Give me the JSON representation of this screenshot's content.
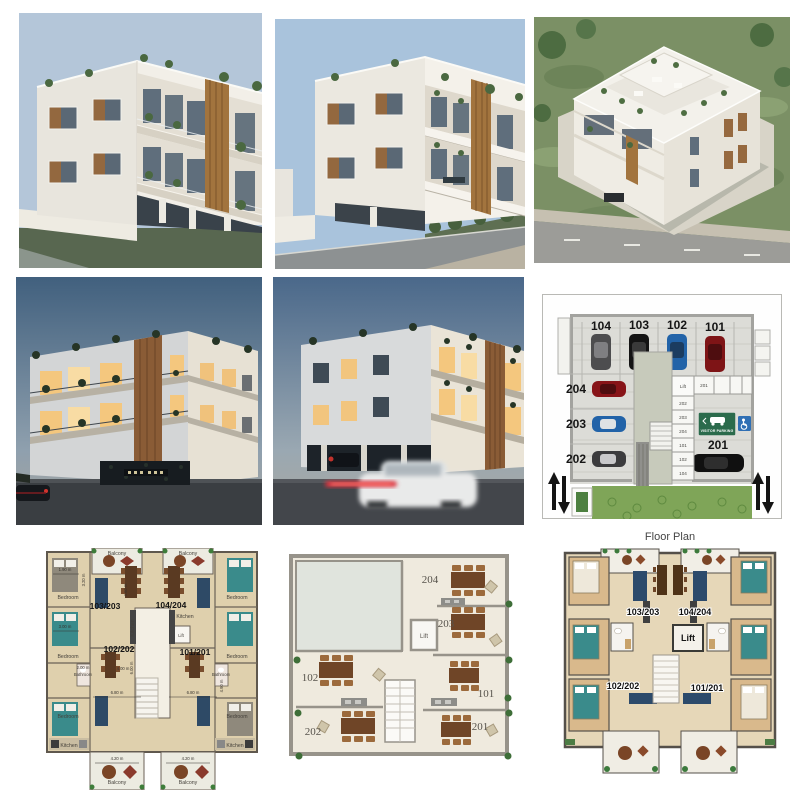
{
  "colors": {
    "sky_day": "#b4c6d9",
    "sky_day2": "#a9c3dc",
    "sky_dusk_top": "#41607e",
    "building_white": "#f2efe8",
    "wood_accent": "#a2743e",
    "visitor_sign_green": "#2b6b4c",
    "accessible_blue": "#2f6fb4",
    "bed_teal": "#3a8b8b",
    "floor_beige": "#dfd0ad"
  },
  "parking": {
    "top_spots": [
      {
        "id": "104",
        "car": "#4d4d4f"
      },
      {
        "id": "103",
        "car": "#141414"
      },
      {
        "id": "102",
        "car": "#2263a8"
      },
      {
        "id": "101",
        "car": "#7e1416"
      }
    ],
    "left_spots": [
      {
        "id": "204",
        "car": "#871418"
      },
      {
        "id": "203",
        "car": "#2263a8"
      },
      {
        "id": "202",
        "car": "#3c3c3e"
      }
    ],
    "bottom_spot": {
      "id": "201",
      "car": "#101010"
    },
    "visitor_sign": "VISITOR PARKING",
    "lift": "Lift",
    "storage_row": [
      "201"
    ],
    "storage_column": [
      "202",
      "203",
      "204",
      "101",
      "102",
      "104"
    ]
  },
  "plan_detailed": {
    "units": {
      "a": "103/203",
      "b": "104/204",
      "c": "102/202",
      "d": "101/201"
    },
    "rooms": {
      "bedroom": "Bedroom",
      "bathroom": "Bathroom",
      "kitchen": "Kitchen",
      "balcony": "Balcony",
      "lift": "Lift"
    },
    "dims": {
      "d1": "1.90 m",
      "d2": "3.20 m",
      "d3": "2.00 m",
      "d4": "3.00 m",
      "d5": "4.60 m",
      "d6": "4.00 m",
      "d7": "4.20 m",
      "d8": "6.80 m",
      "d9": "6.00 m",
      "d10": "4.90 m"
    }
  },
  "plan_simple": {
    "room_ids": [
      "204",
      "203",
      "102",
      "101",
      "202",
      "201"
    ],
    "lift": "Lift"
  },
  "plan_colored": {
    "title": "Floor Plan",
    "units": [
      "103/203",
      "104/204",
      "102/202",
      "101/201"
    ],
    "lift": "Lift"
  }
}
